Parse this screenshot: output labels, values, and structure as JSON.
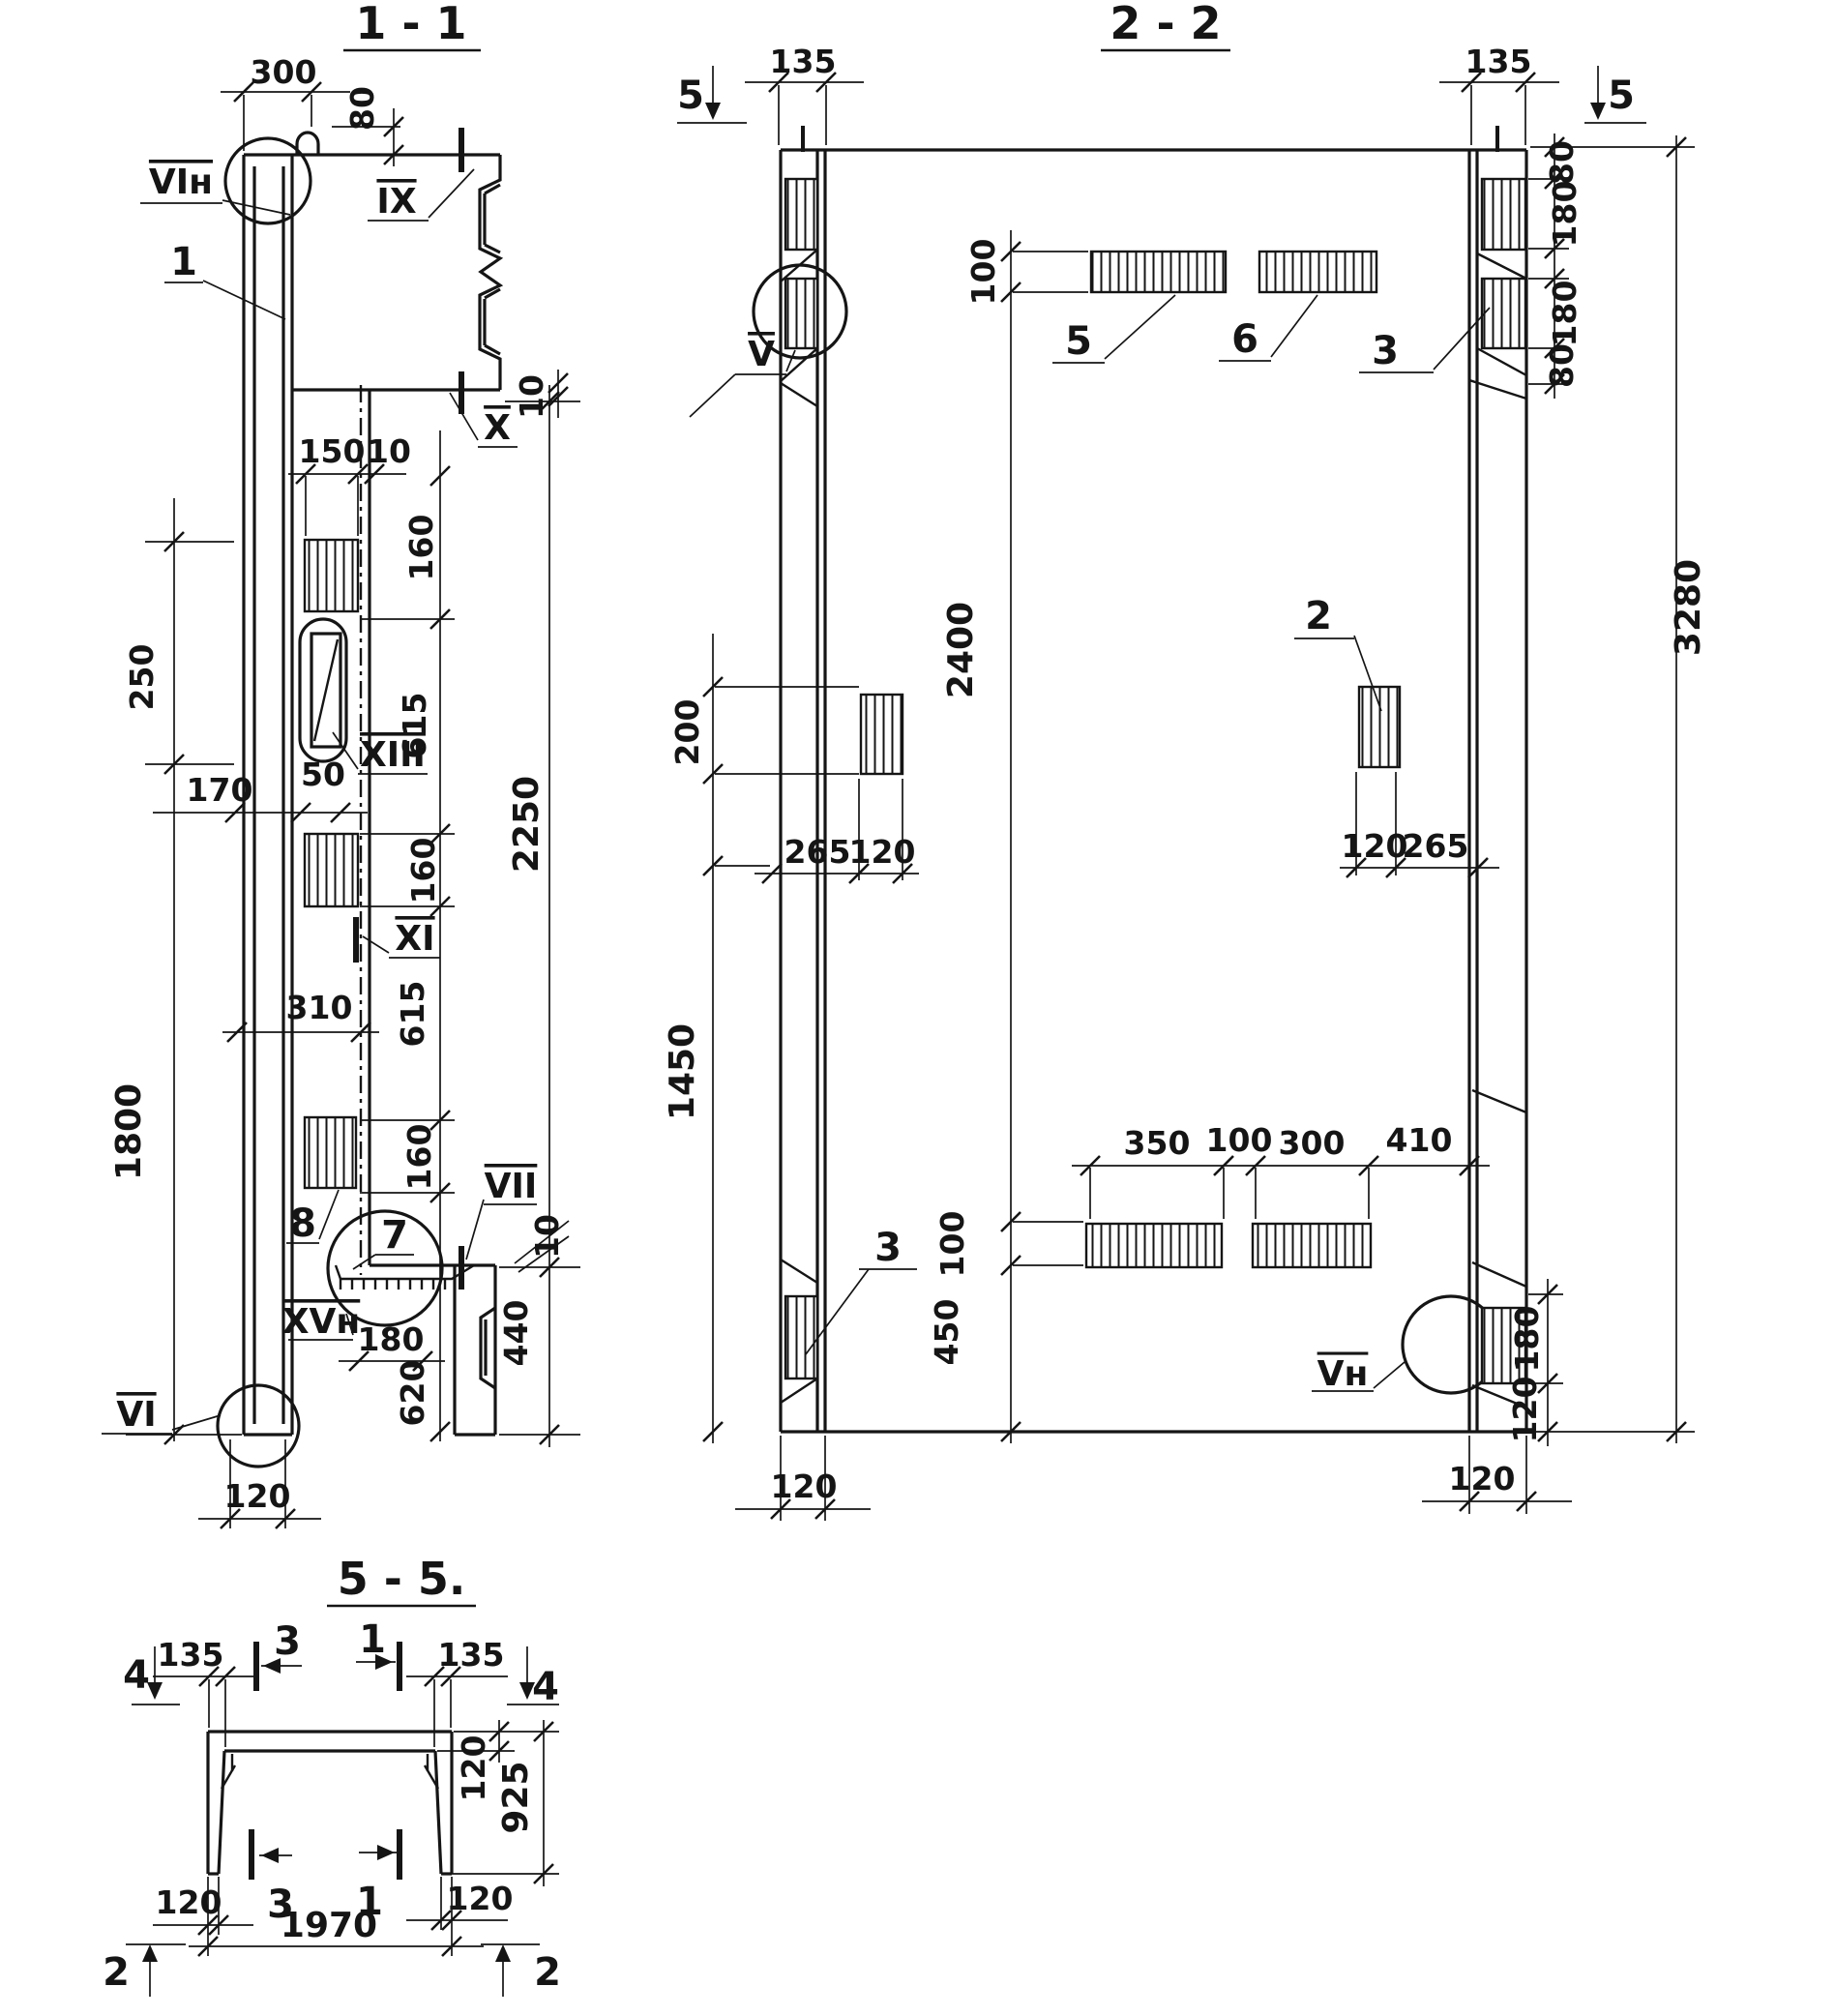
{
  "s11": {
    "title": "1 - 1",
    "d300": "300",
    "d80": "80",
    "d10t": "10",
    "d150": "150",
    "d10m": "10",
    "d160a": "160",
    "d615a": "615",
    "d250": "250",
    "d170": "170",
    "d50": "50",
    "d2250": "2250",
    "d160b": "160",
    "d615b": "615",
    "d310": "310",
    "d1800": "1800",
    "d160c": "160",
    "d10b": "10",
    "d180": "180",
    "d620": "620",
    "d440": "440",
    "d120": "120",
    "vin": "VIн",
    "ix": "IX",
    "x": "X",
    "xiii": "XIII",
    "xi": "XI",
    "vii": "VII",
    "xvn": "XVн",
    "vi": "VI",
    "i1": "1",
    "i7": "7",
    "i8": "8"
  },
  "s22": {
    "title": "2 - 2",
    "m5l": "5",
    "m5r": "5",
    "d135l": "135",
    "d135r": "135",
    "d80a": "80",
    "d180a": "180",
    "d180b": "180",
    "d80b": "80",
    "d3280": "3280",
    "d100t": "100",
    "d200": "200",
    "d265l": "265",
    "d120l": "120",
    "d120r": "120",
    "d265r": "265",
    "d2400": "2400",
    "d1450": "1450",
    "d100b": "100",
    "d450": "450",
    "d350": "350",
    "d100s": "100",
    "d300": "300",
    "d410": "410",
    "d180c": "180",
    "d120c": "120",
    "d120bl": "120",
    "d120br": "120",
    "v": "V",
    "vn": "Vн",
    "i5": "5",
    "i6": "6",
    "i3t": "3",
    "i2": "2",
    "i3b": "3"
  },
  "s55": {
    "title": "5 - 5.",
    "m3t": "3",
    "m1t": "1",
    "m4l": "4",
    "m4r": "4",
    "m3b": "3",
    "m1b": "1",
    "m2l": "2",
    "m2r": "2",
    "d135l": "135",
    "d135r": "135",
    "d120t": "120",
    "d925": "925",
    "d120bl": "120",
    "d120br": "120",
    "d1970": "1970"
  }
}
